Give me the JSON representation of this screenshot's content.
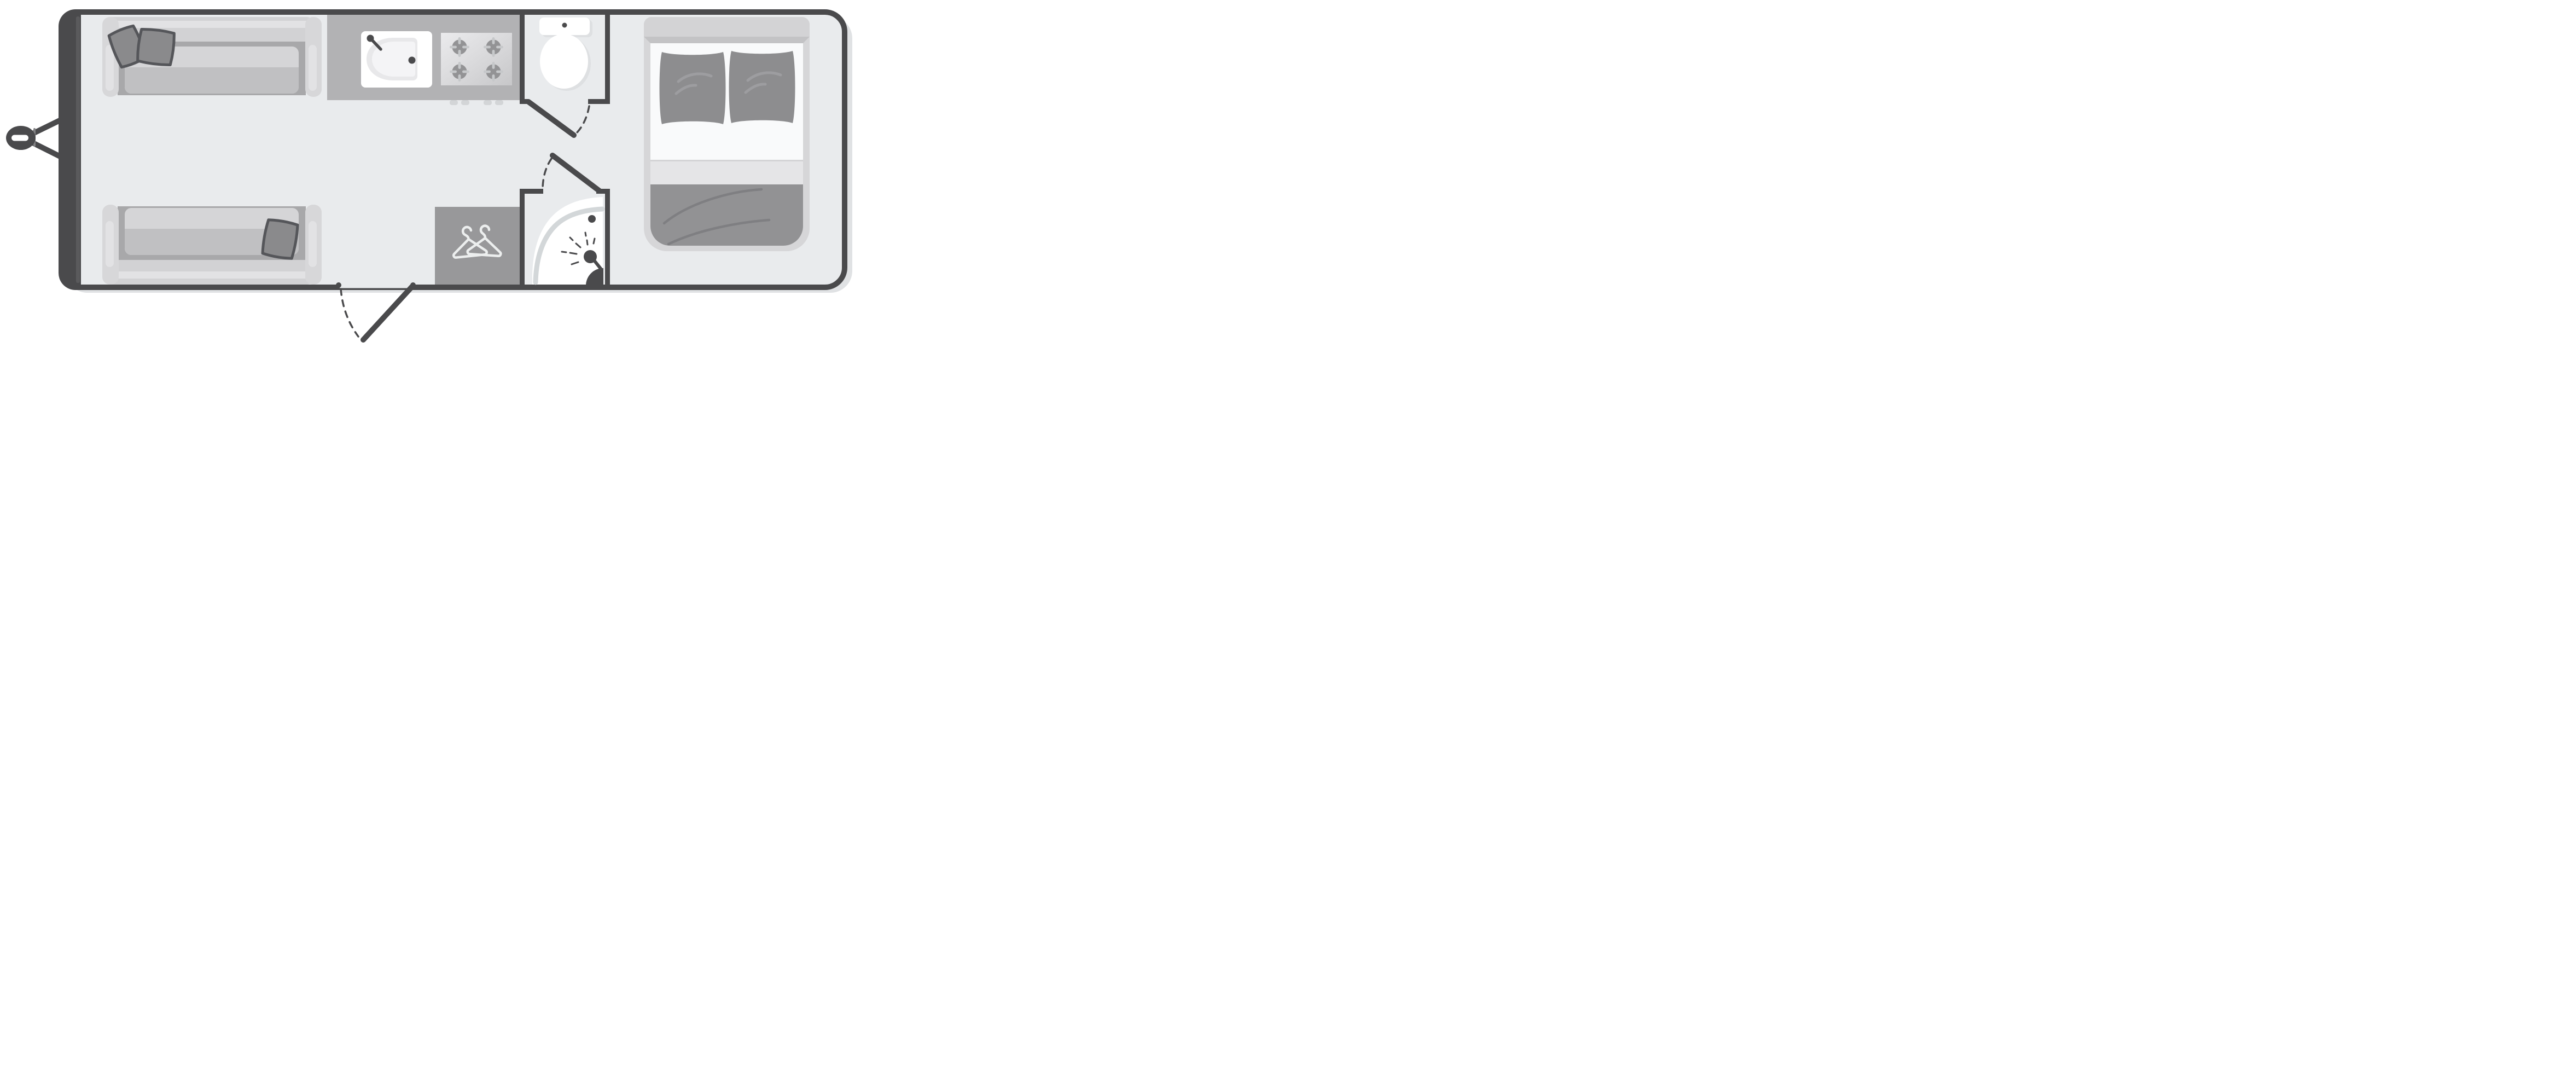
{
  "title": "Caravan floor plan",
  "colors": {
    "wall": "#4a4a4c",
    "wall_inner": "#5a5a5c",
    "floor": "#e9ebed",
    "shadow": "#e0e2e4",
    "white": "#ffffff",
    "jockey": "#828284",
    "sofa_base": "#d7d7d9",
    "sofa_back": "#d2d2d4",
    "sofa_highlight": "#e2e2e4",
    "sofa_shadow": "#a8a8aa",
    "cushion": "#c0c0c2",
    "cushion_light": "#d5d5d7",
    "pillow_fill": "#8a8a8c",
    "pillow_border": "#55565a",
    "counter": "#b2b2b4",
    "knob": "#d3d5d7",
    "basin": "#e8e8ea",
    "basin_inner": "#f4f4f6",
    "stove_light": "#ebebed",
    "stove_mid": "#dcdcde",
    "stove_dark": "#c7c7c9",
    "burner": "#939395",
    "burner_spoke": "#c6c8ca",
    "fixture_shadow": "#dee0e2",
    "wardrobe": "#98989a",
    "hanger": "#eceeee",
    "shower_rim": "#d3d7d9",
    "bed_frame": "#d6d6d8",
    "bed_head": "#d3d3d5",
    "bed_bevel": "#c3c3c5",
    "sheet": "#f9fafb",
    "fold": "#e5e5e7",
    "fold_line": "#d4d4d6",
    "duvet": "#929294",
    "duvet_line": "#7f7f82",
    "bed_pillow": "#8d8d8f",
    "bed_pillow_highlight": "#9d9da0"
  },
  "regions": {
    "caravan": {
      "label": "caravan body outline"
    },
    "hitch": {
      "label": "tow hitch and drawbar"
    },
    "lounge": {
      "label": "front lounge with two sofas",
      "sofa_count": 2,
      "scatter_cushion_count": 3
    },
    "kitchen": {
      "label": "kitchen with sink and gas hob",
      "burner_count": 4,
      "knob_count": 4
    },
    "toilet_room": {
      "label": "toilet compartment with hinged door"
    },
    "shower_room": {
      "label": "corner shower compartment with hinged door"
    },
    "wardrobe": {
      "label": "wardrobe with coat hangers",
      "hanger_count": 2
    },
    "bedroom": {
      "label": "double bed with two pillows",
      "pillow_count": 2
    },
    "entry": {
      "label": "entry doorway with door swing arc"
    }
  }
}
